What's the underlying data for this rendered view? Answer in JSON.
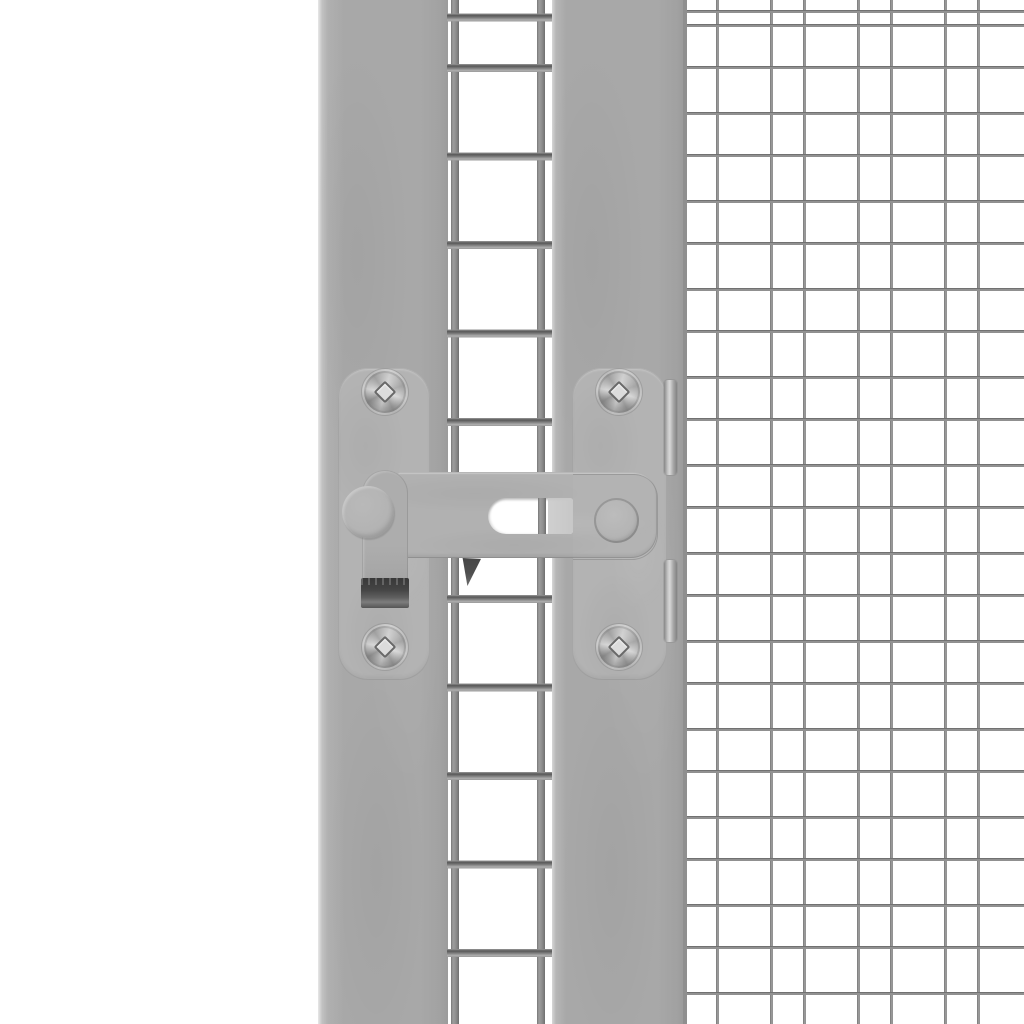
{
  "scene": {
    "alt": "Close-up photo of a grey metal flip latch with a slotted arm, hook strap and two screwed mounting plates, fixed on a grey gate post between a coarse welded-wire door panel and a fine galvanized wire mesh panel on a white background"
  },
  "colors": {
    "background": "#ffffff",
    "post": "#a8a8a8",
    "post-edge-dark": "#9c9c9c",
    "plate": "#b3b3b3",
    "arm": "#b1b1b1",
    "strap": "#adadad",
    "knob": "#b4b4b4",
    "hook-dark": "#454545",
    "hook-light": "#7d7d7d",
    "catch": "#4f4f4f",
    "slot-bg": "#ffffff",
    "slot-shade": "#c7c7c7",
    "wire-coarse": "#949494",
    "wire-coarse-dark": "#575757",
    "wire-fine": "#929292",
    "wire-fine-dark": "#5e5e5e",
    "clip-light": "#d8d8d8",
    "clip-dark": "#878787",
    "screw-face": "#c9c9c9",
    "screw-dark": "#8e8e8e",
    "screw-square": "#dcdcdc"
  }
}
